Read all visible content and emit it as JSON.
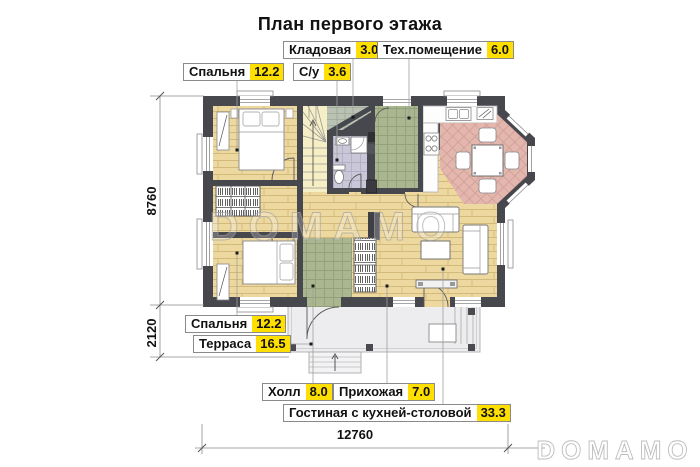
{
  "title": "План первого этажа",
  "rooms": [
    {
      "name": "Спальня",
      "area": "12.2"
    },
    {
      "name": "С/у",
      "area": "3.6"
    },
    {
      "name": "Кладовая",
      "area": "3.0"
    },
    {
      "name": "Тех.помещение",
      "area": "6.0"
    },
    {
      "name": "Спальня",
      "area": "12.2"
    },
    {
      "name": "Терраса",
      "area": "16.5"
    },
    {
      "name": "Холл",
      "area": "8.0"
    },
    {
      "name": "Прихожая",
      "area": "7.0"
    },
    {
      "name": "Гостиная с кухней-столовой",
      "area": "33.3"
    }
  ],
  "dimensions": {
    "height_main": "8760",
    "height_terrace": "2120",
    "width_total": "12760"
  },
  "watermarks": {
    "center": "DOMAMO",
    "corner": "DOMAMO"
  },
  "colors": {
    "wall": "#47474e",
    "wood_floor": "#edd9a0",
    "tile_green": "#aab690",
    "tile_lavender": "#cac7d9",
    "tile_pink": "#e3b7ae",
    "terrace": "#ededf0",
    "label_value_bg": "#ffdf00"
  }
}
